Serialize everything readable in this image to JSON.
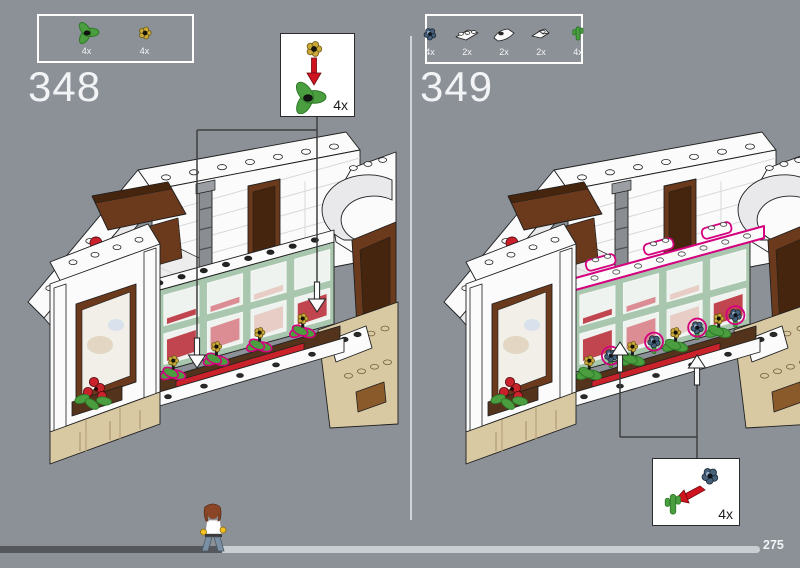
{
  "document": {
    "kind": "lego-building-instruction-page",
    "page_number": "275"
  },
  "steps": [
    {
      "id": "348",
      "parts": [
        {
          "icon": "plant-leaves-icon",
          "qty": "4x"
        },
        {
          "icon": "gold-flower-icon",
          "qty": "4x"
        }
      ],
      "callout": {
        "qty": "4x",
        "top_part": "gold-flower-icon",
        "bottom_part": "plant-leaves-icon",
        "arrow": "red-arrow-down"
      },
      "annotation_arrows": "down"
    },
    {
      "id": "349",
      "parts": [
        {
          "icon": "sand-blue-flower-icon",
          "qty": "4x"
        },
        {
          "icon": "white-plate-1x3-icon",
          "qty": "2x"
        },
        {
          "icon": "white-curved-slope-icon",
          "qty": "2x"
        },
        {
          "icon": "white-angle-plate-icon",
          "qty": "2x"
        },
        {
          "icon": "green-stem-icon",
          "qty": "4x"
        }
      ],
      "callout": {
        "qty": "4x",
        "top_part": "sand-blue-flower-icon",
        "bottom_part": "green-stem-icon",
        "arrow": "red-arrow-diagonal"
      },
      "annotation_arrows": "up"
    }
  ],
  "progress": {
    "completed_ratio": 0.292,
    "bar_right_px": 760
  },
  "palette": {
    "page_bg": "#8b9197",
    "divider": "#d9dcde",
    "step_number": "#f1f3f5",
    "box_border": "#ffffff",
    "part_label": "#f4f5f6",
    "outline": "#1f1f1f",
    "white": "#fbfbfc",
    "shade": "#e9e9ec",
    "line_light": "#d8d8db",
    "wall_green": "#a9c7ae",
    "pane": "#eef3ef",
    "pane_pinks": [
      "#e4b7ba",
      "#c1454e",
      "#db8d93",
      "#e7cdc6",
      "#c1454e"
    ],
    "tan": "#d9c9a3",
    "tan_shade": "#c2a97c",
    "brown": "#6b3a1c",
    "brown_dark": "#46250e",
    "wood": "#8a5a2a",
    "ledge": "#53331b",
    "red": "#c9222b",
    "leaf": "#4a9e3f",
    "leaf_dark": "#2f7a2a",
    "gold": "#c9a83a",
    "sand_blue": "#46607a",
    "sand_blue_light": "#9ab0c4",
    "magenta": "#d4007f",
    "gray_column": "#8a8d91",
    "leader_line": "#3f3f3f",
    "arrow_red": "#cf1420",
    "arrow_red_dark": "#6e0a10",
    "progress_dark": "#54585c",
    "progress_light": "#c9ced2",
    "page_number": "#f2f4f6",
    "minifig_hair": "#8a4527",
    "minifig_shirt": "#ffffff",
    "minifig_hands": "#f2c021",
    "minifig_legs": "#7b8fa5"
  }
}
